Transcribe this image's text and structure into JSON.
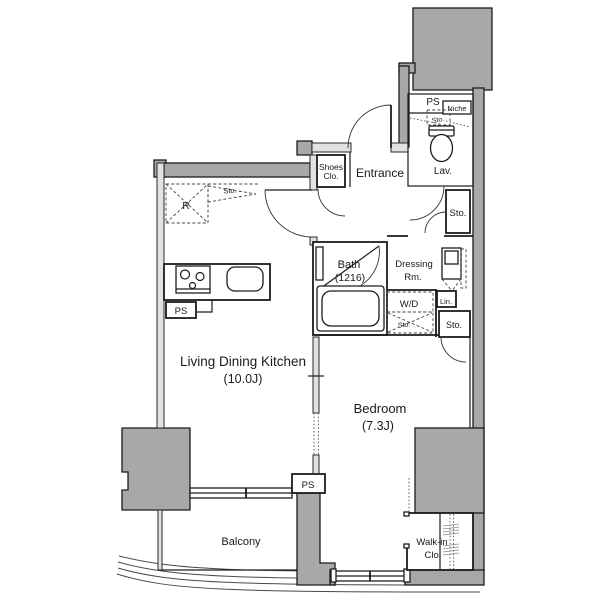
{
  "floorplan": {
    "labels": {
      "ps_top": "PS",
      "niche": "Niche",
      "sto_niche": "Sto.",
      "lav": "Lav.",
      "sto_hall": "Sto.",
      "entrance": "Entrance",
      "shoes_line1": "Shoes",
      "shoes_line2": "Clo.",
      "bath_line1": "Bath",
      "bath_line2": "(1216)",
      "dressing_line1": "Dressing",
      "dressing_line2": "Rm.",
      "wd": "W/D",
      "sto_wd": "Sto.",
      "lin": "Lin.",
      "sto_bedroom": "Sto.",
      "fridge": "R",
      "sto_kitchen": "Sto.",
      "ps_kitchen": "PS",
      "ldk_line1": "Living Dining Kitchen",
      "ldk_line2": "(10.0J)",
      "bedroom_line1": "Bedroom",
      "bedroom_line2": "(7.3J)",
      "balcony": "Balcony",
      "ps_balcony": "PS",
      "walkin_line1": "Walk-in",
      "walkin_line2": "Clo."
    },
    "colors": {
      "wall_dark": "#a8a8a8",
      "wall_light": "#e2e2e2",
      "line": "#1c1c1c",
      "background": "#ffffff"
    }
  }
}
